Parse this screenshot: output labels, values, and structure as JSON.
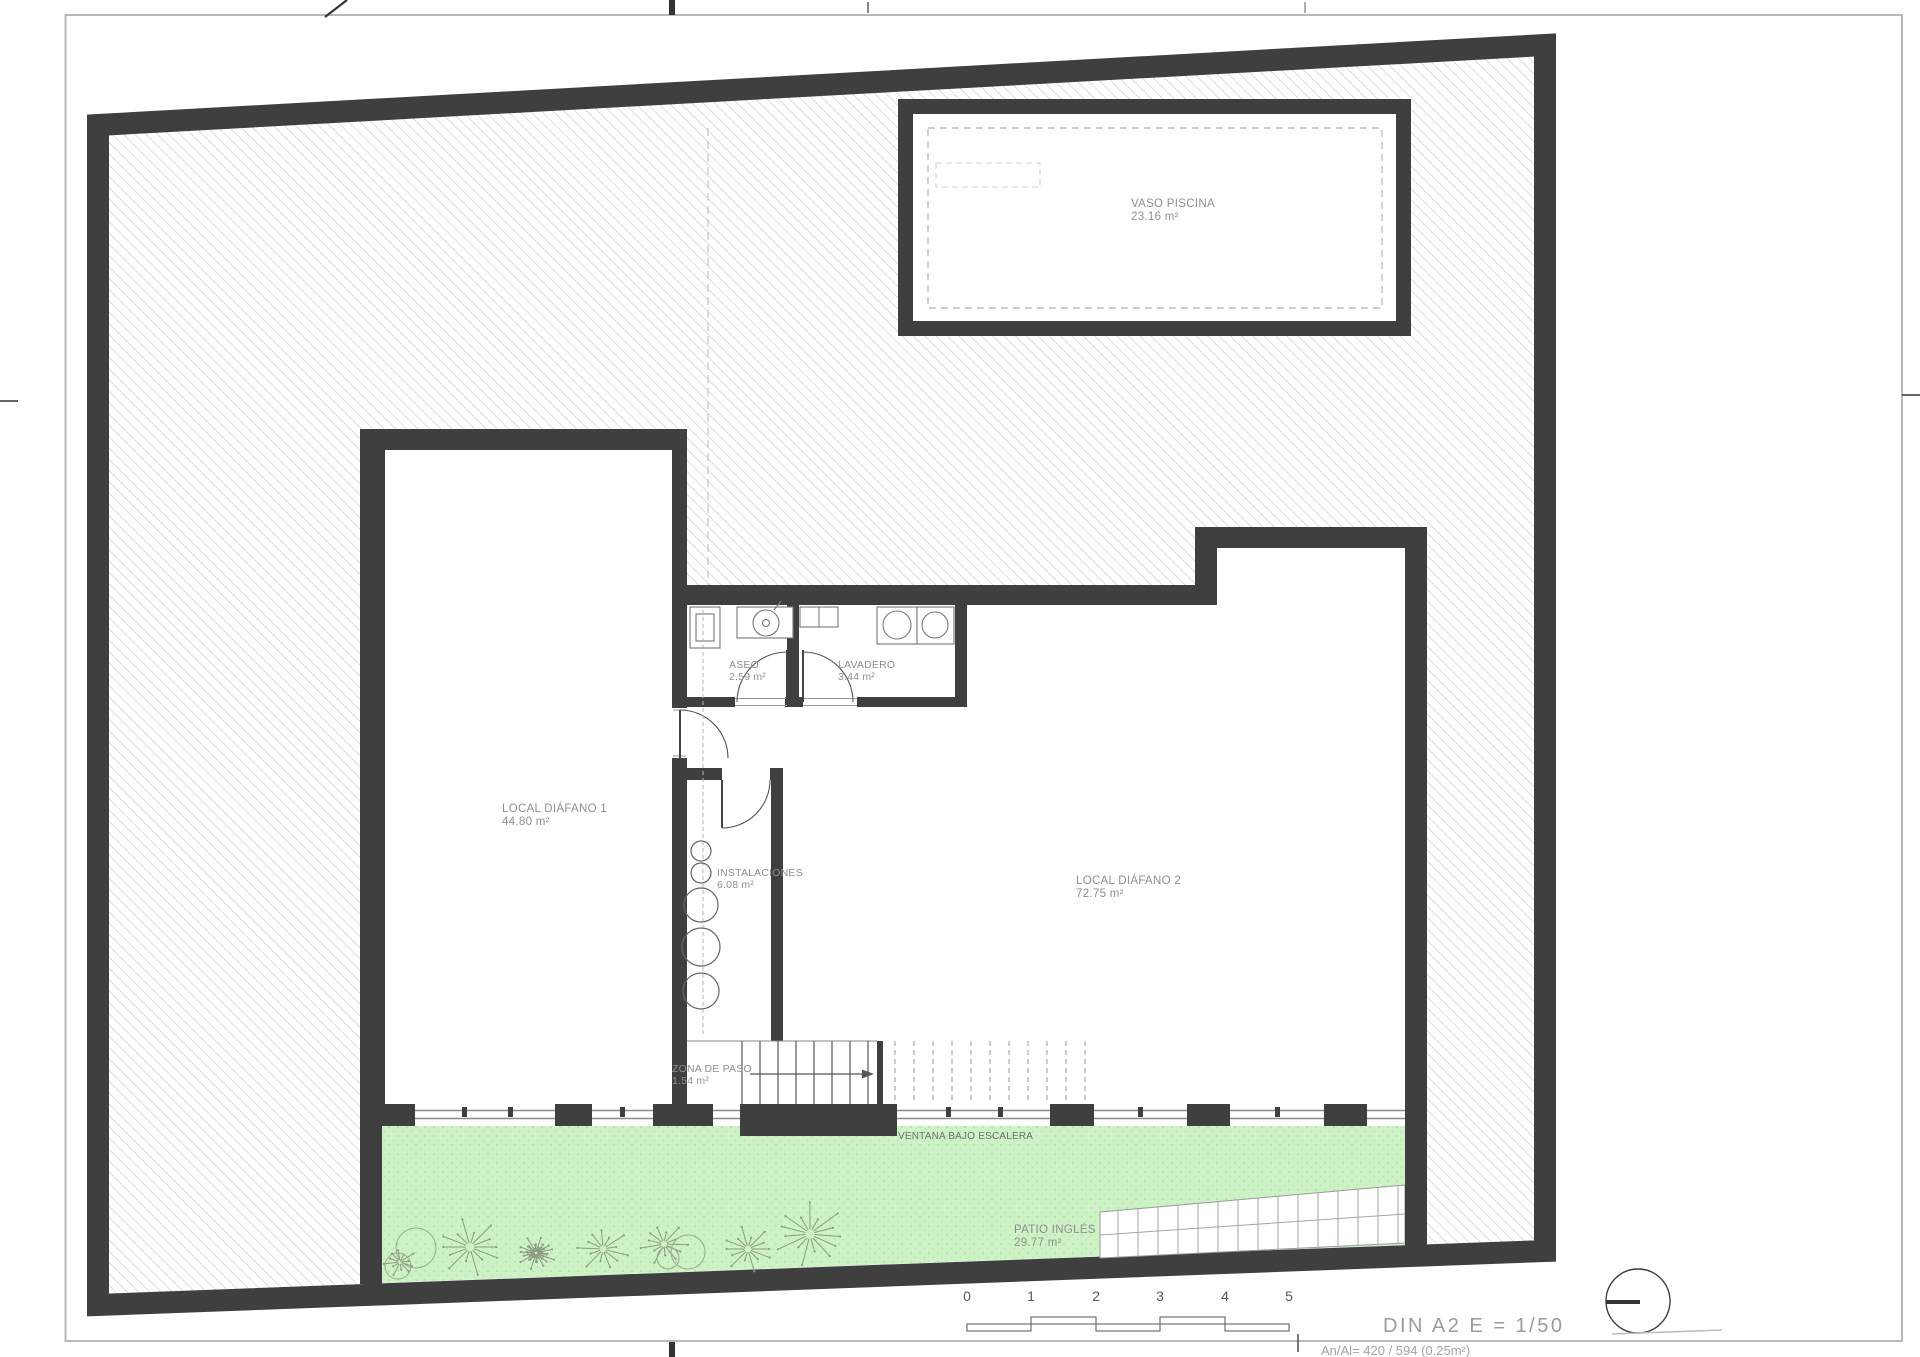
{
  "sheet": {
    "format_scale": "DIN A2  E = 1/50",
    "sheet_info": "An/Al= 420 / 594 (0.25m²)"
  },
  "plan": {
    "pool": {
      "name": "VASO PISCINA",
      "area": "23.16 m²"
    },
    "rooms": {
      "local_diafano_1": {
        "name": "LOCAL DIÁFANO 1",
        "area": "44.80 m²"
      },
      "local_diafano_2": {
        "name": "LOCAL DIÁFANO 2",
        "area": "72.75 m²"
      },
      "aseo": {
        "name": "ASEO",
        "area": "2.59 m²"
      },
      "lavadero": {
        "name": "LAVADERO",
        "area": "3.44 m²"
      },
      "instalaciones": {
        "name": "INSTALACIONES",
        "area": "6.08 m²"
      },
      "zona_de_paso": {
        "name": "ZONA DE PASO",
        "area": "1.54 m²"
      },
      "patio_ingles": {
        "name": "PATIO INGLÉS",
        "area": "29.77 m²"
      }
    },
    "annotations": {
      "ventana_bajo_escalera": "VENTANA BAJO ESCALERA"
    },
    "scale_bar": {
      "ticks": [
        "0",
        "1",
        "2",
        "3",
        "4",
        "5"
      ]
    },
    "colors": {
      "wall": "#3f3f3f",
      "patio_green": "#cdf2c6",
      "hatch_line": "#cbcbcb",
      "label_text": "#8f8f8f"
    }
  }
}
